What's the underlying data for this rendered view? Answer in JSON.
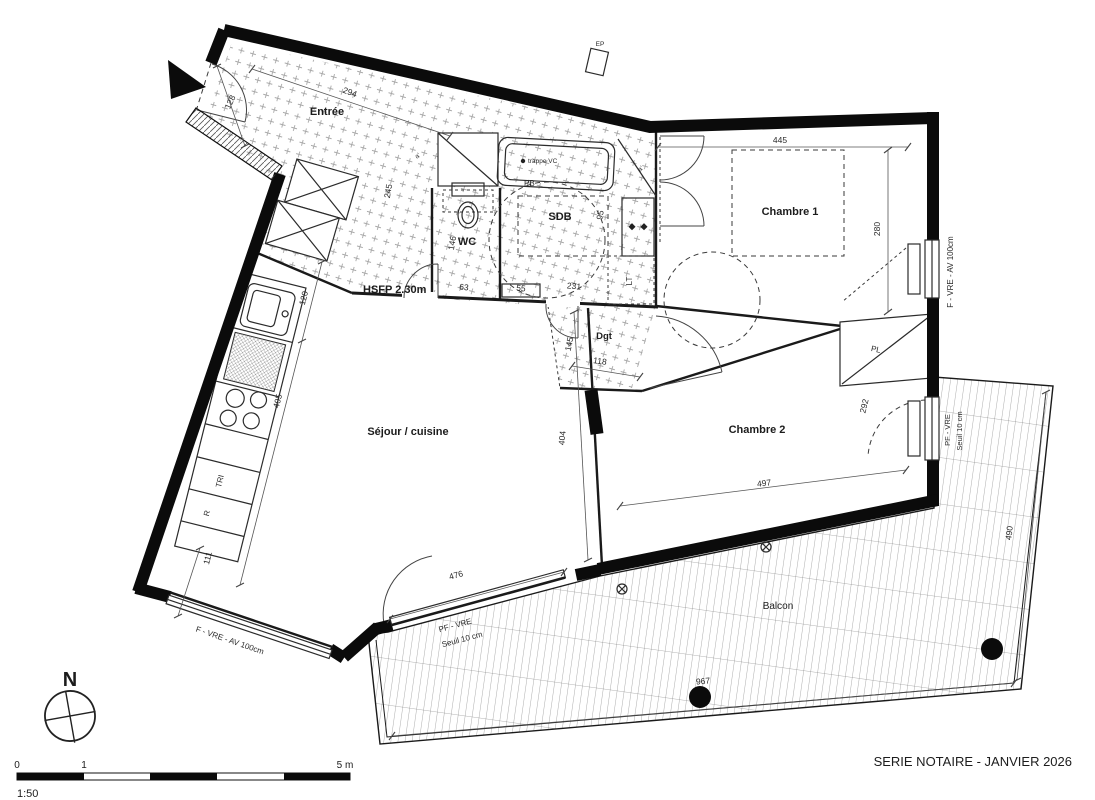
{
  "plan": {
    "rooms": {
      "entree": "Entrée",
      "sdb": "SDB",
      "wc": "WC",
      "chambre1": "Chambre 1",
      "chambre2": "Chambre 2",
      "sejour": "Séjour / cuisine",
      "dgt": "Dgt",
      "balcon": "Balcon"
    },
    "annotations": {
      "hsfp": "HSFP 2.30m",
      "trappe_vc": "trappe VC",
      "pb": "PB",
      "pl": "PL",
      "lt": "LT",
      "ep": "EP",
      "a_mark": "a'",
      "tri": "TRI",
      "r": "R",
      "f_vre": "F - VRE - AV 100cm",
      "pf_vre": "PF - VRE",
      "seuil": "Seuil 10 cm"
    },
    "dims": {
      "d294": "294",
      "d128": "128",
      "d445": "445",
      "d280": "280",
      "d120": "120",
      "d405": "405",
      "d111": "111",
      "d146": "146",
      "d245": "245",
      "d63": "63",
      "d55": "55",
      "d231": "231",
      "d95": "95",
      "d145": "145",
      "d118": "118",
      "d404": "404",
      "d497": "497",
      "d292": "292",
      "d476": "476",
      "d490": "490",
      "d967": "967"
    },
    "colors": {
      "ink": "#111111",
      "dots": "#9b9b9b",
      "deck_line": "#666666"
    }
  },
  "titleblock": {
    "series": "SERIE NOTAIRE - JANVIER 2026",
    "scale": "1:50",
    "tick0": "0",
    "tick1": "1",
    "tick5": "5 m",
    "north": "N"
  }
}
